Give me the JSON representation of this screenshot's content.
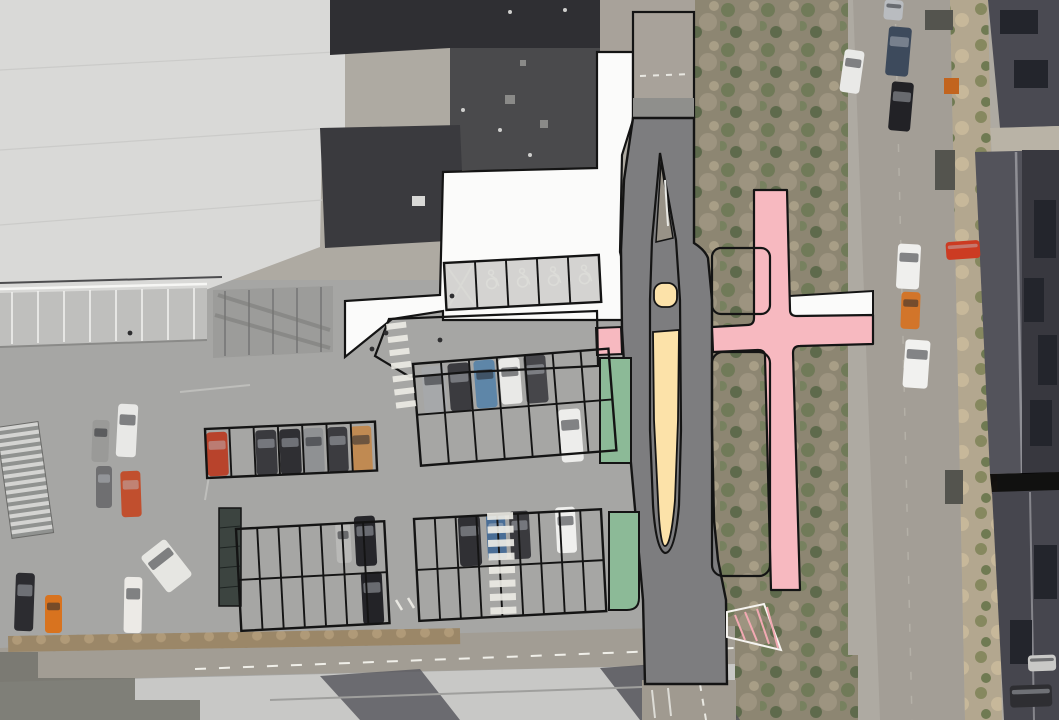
{
  "meta": {
    "kind": "aerial-photo-site-plan",
    "width": 1059,
    "height": 720,
    "visible_text": "none"
  },
  "colors": {
    "outline": "#141414",
    "plan_road_gray": "#7d7d7f",
    "plan_pink": "#f7b9c0",
    "plan_green": "#8cba97",
    "plan_cream": "#fce2a9",
    "plan_white": "#fbfbfa",
    "photo_asphalt": "#a6a6a4",
    "photo_big_roof": "#d9d9d7",
    "photo_dark_roof": "#3a3a3e",
    "photo_scrub_base": "#8d8672",
    "photo_street": "#a39e96",
    "zebra_white": "#eceae4"
  },
  "overlays": {
    "new_road": {
      "fill_key": "plan_road_gray"
    },
    "median_island": {
      "fill_key": "plan_cream"
    },
    "pink_route": {
      "fill_key": "plan_pink"
    },
    "side_strip": {
      "fill_key": "plan_white"
    },
    "green_strips": [
      {
        "x": 600,
        "y": 358,
        "w": 31,
        "h": 105
      },
      {
        "x": 609,
        "y": 512,
        "w": 30,
        "h": 98
      }
    ],
    "tree_patches": [
      {
        "x": 712,
        "y": 248,
        "w": 58,
        "h": 66
      },
      {
        "x": 712,
        "y": 352,
        "w": 58,
        "h": 224
      }
    ]
  },
  "parking": {
    "rows": [
      {
        "id": "accessible-row",
        "x": 444,
        "y": 263,
        "cols": 5,
        "rows": 1,
        "stall_w": 31,
        "stall_h": 47,
        "rot": -3,
        "fill": "#b4b2ae",
        "symbols": "accessible",
        "cross_first": true
      },
      {
        "id": "row-a",
        "x": 205,
        "y": 429,
        "cols": 7,
        "rows": 1,
        "stall_w": 24.3,
        "stall_h": 49,
        "rot": -2.5
      },
      {
        "id": "block-b",
        "x": 413,
        "y": 364,
        "cols": 7,
        "rows": 2,
        "stall_w": 28,
        "stall_h": 51,
        "rot": -4.5
      },
      {
        "id": "block-c",
        "x": 236,
        "y": 529,
        "cols": 7,
        "rows": 2,
        "stall_w": 21.2,
        "stall_h": 51,
        "rot": -3
      },
      {
        "id": "block-d",
        "x": 414,
        "y": 519,
        "cols": 9,
        "rows": 2,
        "stall_w": 20.8,
        "stall_h": 51,
        "rot": -3
      }
    ]
  },
  "zebras": [
    {
      "x": 487,
      "y": 513,
      "count": 8,
      "w": 26,
      "h": 7,
      "gap": 6.5,
      "rot": -2
    },
    {
      "x": 386,
      "y": 324,
      "count": 7,
      "w": 20,
      "h": 6,
      "gap": 7.2,
      "rot": -7
    }
  ],
  "cars": [
    [
      92,
      420,
      17,
      42,
      "#9a9a98",
      2
    ],
    [
      117,
      404,
      20,
      53,
      "#e8e8e6",
      3
    ],
    [
      96,
      466,
      16,
      42,
      "#6f6f71",
      0
    ],
    [
      121,
      471,
      20,
      46,
      "#c14f2e",
      -2
    ],
    [
      15,
      573,
      19,
      58,
      "#2c2c30",
      2
    ],
    [
      45,
      595,
      17,
      38,
      "#d8731f",
      0
    ],
    [
      124,
      577,
      18,
      56,
      "#eceae6",
      1
    ],
    [
      151,
      543,
      31,
      46,
      "#e6e6e2",
      -38
    ],
    [
      207,
      432,
      21,
      44,
      "#b8432c",
      -2.5
    ],
    [
      256,
      430,
      21,
      45,
      "#3a3a3e",
      -2.5
    ],
    [
      280,
      429,
      21,
      45,
      "#2f2f33",
      -2.5
    ],
    [
      304,
      428,
      20,
      45,
      "#8f9193",
      -2.5
    ],
    [
      328,
      427,
      20,
      45,
      "#3c3c40",
      -2.5
    ],
    [
      351,
      426,
      21,
      46,
      "#c08a52",
      -2.5
    ],
    [
      423,
      366,
      23,
      47,
      "#a6a8aa",
      -4.5
    ],
    [
      449,
      363,
      22,
      48,
      "#3b3b3f",
      -4.5
    ],
    [
      475,
      360,
      21,
      48,
      "#5e86a8",
      -4.5
    ],
    [
      500,
      358,
      21,
      46,
      "#e9e9e7",
      -4.5
    ],
    [
      525,
      355,
      22,
      48,
      "#46464a",
      -4.5
    ],
    [
      560,
      409,
      22,
      53,
      "#ededeb",
      -4.5
    ],
    [
      336,
      523,
      15,
      40,
      "#b9b9b7",
      -3
    ],
    [
      355,
      516,
      21,
      50,
      "#26262a",
      -3
    ],
    [
      362,
      572,
      21,
      52,
      "#232327",
      -3
    ],
    [
      459,
      516,
      22,
      50,
      "#303034",
      -3
    ],
    [
      487,
      514,
      19,
      46,
      "#4a6e96",
      -3
    ],
    [
      510,
      511,
      20,
      48,
      "#3a3a3e",
      -3
    ],
    [
      556,
      507,
      20,
      46,
      "#f0f0ee",
      -3
    ],
    [
      884,
      0,
      19,
      20,
      "#b9bcc0",
      5
    ],
    [
      887,
      27,
      23,
      49,
      "#3d4a5c",
      5
    ],
    [
      890,
      82,
      22,
      49,
      "#222226",
      5
    ],
    [
      842,
      50,
      20,
      43,
      "#e9e9e7",
      8
    ],
    [
      897,
      244,
      23,
      45,
      "#efefed",
      3
    ],
    [
      901,
      292,
      19,
      37,
      "#d2752a",
      2
    ],
    [
      904,
      340,
      25,
      48,
      "#f1f1ef",
      4
    ],
    [
      946,
      241,
      34,
      18,
      "#cc3b22",
      -4
    ],
    [
      1010,
      685,
      42,
      22,
      "#2e2e32",
      -2
    ],
    [
      1028,
      655,
      28,
      16,
      "#c9c9c7",
      -2
    ]
  ],
  "people": [
    [
      372,
      349
    ],
    [
      386,
      333
    ],
    [
      130,
      333
    ],
    [
      440,
      340
    ],
    [
      452,
      296
    ]
  ]
}
